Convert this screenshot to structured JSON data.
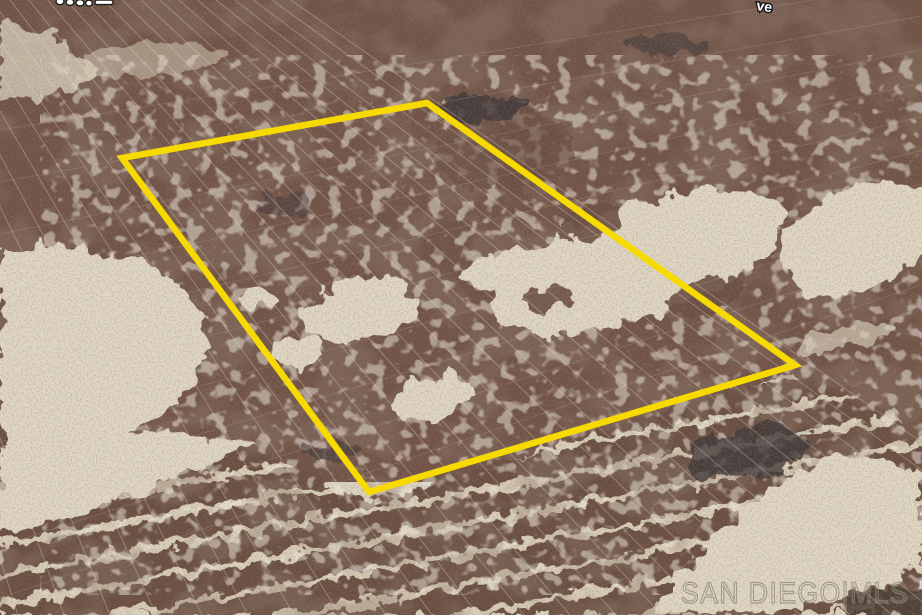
{
  "scene": {
    "type": "aerial-satellite-photo",
    "subject": "vacant desert land parcel with boundary outline",
    "parcel_boundary": {
      "color": "#f7da00",
      "stroke_width": 6.5,
      "points": [
        [
          122,
          158
        ],
        [
          427,
          103
        ],
        [
          795,
          365
        ],
        [
          369,
          492
        ]
      ]
    },
    "street_label_fragments": {
      "top_right": "ve"
    },
    "watermark": {
      "text": "SAN DIEGO|MLS",
      "color": "#8d8478"
    },
    "terrain_palette": {
      "sand": "#dbd2bf",
      "light_sand": "#e2dac7",
      "scrub_brown": "#715447",
      "band_brown": "#6b5043",
      "band_sand_line": "#d7ccb6",
      "dark_patch": "#3f3839"
    },
    "perspective": {
      "furrow_vanishing_point": [
        -311,
        -422
      ],
      "furrow_spacing_bottom": 46
    }
  }
}
